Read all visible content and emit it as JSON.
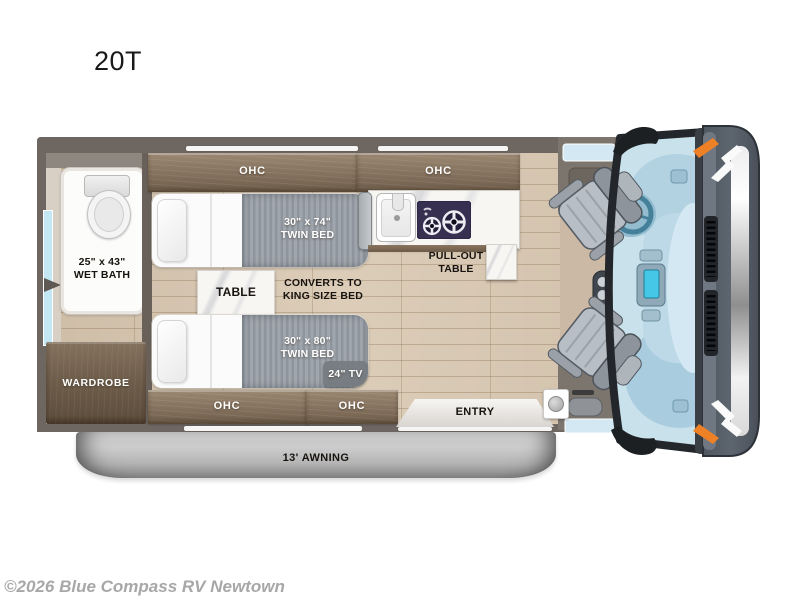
{
  "title": "20T",
  "watermark": "©2026 Blue Compass RV Newtown",
  "colors": {
    "wall": "#6e6761",
    "cabinet_wood": "#8a7763",
    "floor_wood": "#d6c6b1",
    "mattress_gray": "#9aa0a7",
    "awning_gray": "#bdbdbd",
    "glass_blue": "#c9e1ea",
    "accent_orange": "#ee8126"
  },
  "labels": {
    "ohc_top_left": "OHC",
    "ohc_top_kitchen": "OHC",
    "ohc_bottom_left": "OHC",
    "ohc_bottom_right": "OHC",
    "wet_bath_size": "25\" x 43\"",
    "wet_bath_name": "WET BATH",
    "wardrobe": "WARDROBE",
    "twin_bed_top_size": "30\" x 74\"",
    "twin_bed_top_name": "TWIN BED",
    "twin_bed_bottom_size": "30\" x 80\"",
    "twin_bed_bottom_name": "TWIN BED",
    "table": "TABLE",
    "king_line1": "CONVERTS TO",
    "king_line2": "KING SIZE BED",
    "tv": "24\" TV",
    "pullout_line1": "PULL-OUT",
    "pullout_line2": "TABLE",
    "entry": "ENTRY",
    "awning": "13' AWNING"
  }
}
